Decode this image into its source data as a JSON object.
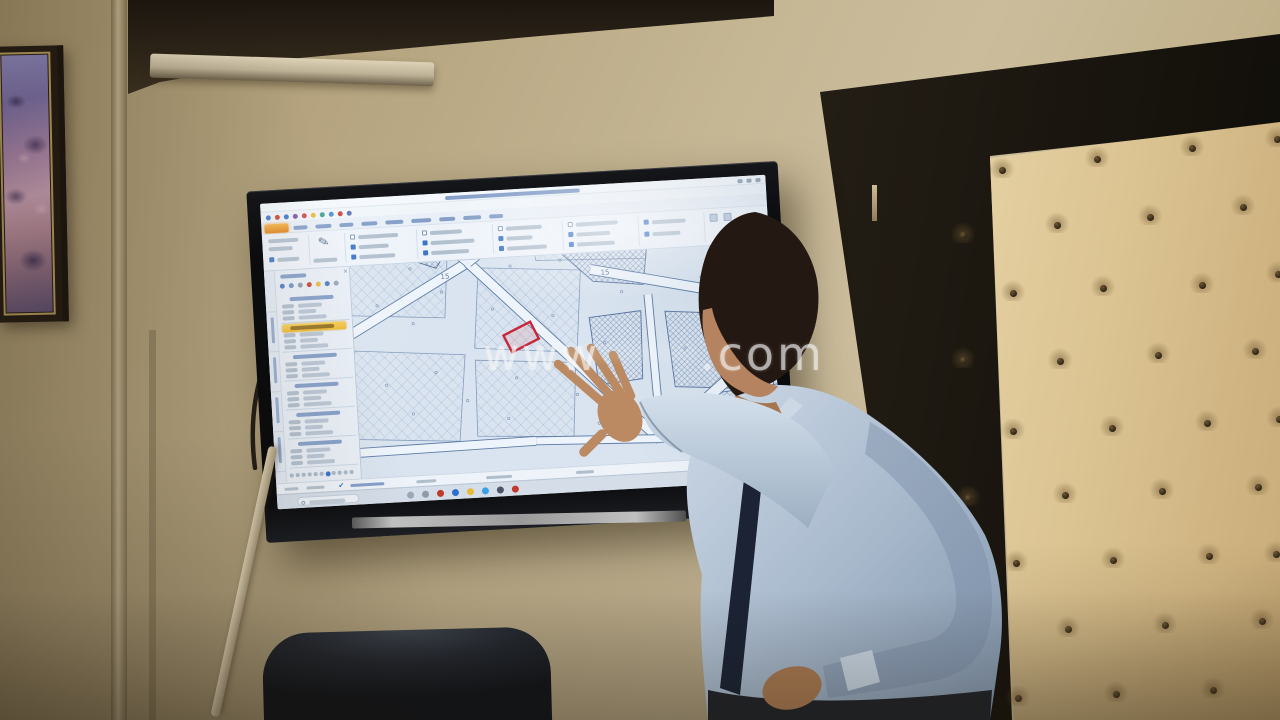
{
  "watermark": {
    "left": "www",
    "right": ".com"
  },
  "palette": {
    "wall": "#c5b694",
    "cornice": "#2a2014",
    "tuft_leather": "#ecd9ac",
    "door_frame": "#17130c",
    "shirt": "#b3c2d4",
    "tie": "#1b2335",
    "skin": "#bb8a62",
    "screen_bg": "#dce7f2",
    "highlight_marker": "#f3c13a",
    "file_button": "#e8920c",
    "red_parcel": "#c8273a",
    "start_blue": "#2f7fd6"
  },
  "screen": {
    "title": {
      "bar": [
        185,
        3,
        135
      ],
      "buttons": 3
    },
    "qat": {
      "y": 11,
      "x0": 5,
      "step": 9,
      "size": 5,
      "colors": [
        "#3a72c8",
        "#c94030",
        "#3a72c8",
        "#7a52a8",
        "#d04545",
        "#e8b93a",
        "#3aa089",
        "#4a8ad0",
        "#c94030",
        "#5a6fae"
      ]
    },
    "tabs": {
      "file": [
        3,
        20,
        24,
        9
      ],
      "y": 24,
      "items": [
        [
          32,
          14
        ],
        [
          54,
          16
        ],
        [
          78,
          14
        ],
        [
          100,
          16
        ],
        [
          124,
          18
        ],
        [
          150,
          20
        ],
        [
          178,
          16
        ],
        [
          202,
          18
        ],
        [
          228,
          14
        ]
      ]
    },
    "ribbon": {
      "seps": [
        46,
        82,
        154,
        230,
        300,
        376,
        442
      ],
      "pencil": [
        56,
        36
      ],
      "bars": [
        [
          6,
          36,
          30
        ],
        [
          6,
          44,
          24
        ],
        [
          50,
          58,
          24
        ]
      ],
      "g1cb": [
        6,
        54,
        22
      ],
      "cbgroups": [
        {
          "x": 88,
          "rows": [
            [
              36,
              40
            ],
            [
              46,
              30
            ],
            [
              56,
              36
            ]
          ]
        },
        {
          "x": 160,
          "rows": [
            [
              36,
              32
            ],
            [
              46,
              44
            ],
            [
              56,
              38
            ]
          ]
        },
        {
          "x": 236,
          "rows": [
            [
              36,
              36
            ],
            [
              46,
              26
            ],
            [
              56,
              40
            ]
          ]
        },
        {
          "x": 306,
          "rows": [
            [
              36,
              42
            ],
            [
              46,
              34
            ],
            [
              56,
              38
            ]
          ]
        },
        {
          "x": 382,
          "rows": [
            [
              38,
              34
            ],
            [
              50,
              28
            ]
          ]
        }
      ],
      "icon_squares": [
        [
          448,
          36
        ],
        [
          462,
          36
        ]
      ],
      "checked_pattern": [
        1,
        0,
        1,
        1,
        0,
        1,
        1,
        0,
        1,
        1,
        0,
        1,
        1,
        1
      ]
    },
    "panel": {
      "tabstrip": {
        "seps": [
          40,
          80,
          120,
          160,
          200
        ],
        "bars": [
          [
            46,
            26
          ],
          [
            86,
            26
          ],
          [
            126,
            26
          ],
          [
            166,
            26
          ]
        ]
      },
      "header_bar": [
        16,
        4,
        26
      ],
      "close": [
        79,
        4
      ],
      "tools": {
        "y": 13,
        "x0": 15,
        "step": 9,
        "colors": [
          "#4a7ac0",
          "#6b8fc9",
          "#8f9cab",
          "#c94030",
          "#e8b93a",
          "#4a7ac0",
          "#98a5b4"
        ]
      },
      "cards": {
        "y0": 24,
        "h": 29,
        "count": 6,
        "highlight_index": 1,
        "value_w": [
          24,
          18,
          28
        ]
      },
      "footer": {
        "y": 203,
        "x0": 14,
        "step": 6,
        "count": 11,
        "active_index": 6,
        "active_color": "#2f6fd0"
      }
    },
    "status": {
      "bars": [
        [
          8,
          14
        ],
        [
          30,
          18
        ],
        [
          74,
          34
        ],
        [
          140,
          20
        ],
        [
          210,
          26
        ],
        [
          300,
          18
        ],
        [
          468,
          24
        ]
      ],
      "check_x": 62,
      "check": "✔"
    },
    "taskbar": {
      "search": [
        20,
        3,
        62,
        9
      ],
      "icons": {
        "x0": 130,
        "step": 15,
        "size": 7,
        "names": [
          "pinned-app-icon",
          "pinned-app-icon",
          "browser-red-icon",
          "edge-icon",
          "files-icon",
          "skype-icon",
          "office-icon",
          "media-red-icon"
        ],
        "colors": [
          "#9aa7b6",
          "#8d9aa9",
          "#c0392b",
          "#2c6fd0",
          "#e8b93a",
          "#3aa0e8",
          "#4a5568",
          "#c0392b"
        ]
      },
      "tray_x": 466
    },
    "map": {
      "w": 420,
      "h": 211,
      "streets": [
        [
          118,
          2,
          -30,
          82,
          9
        ],
        [
          118,
          2,
          300,
          190,
          9
        ],
        [
          118,
          2,
          196,
          -54,
          9
        ],
        [
          118,
          2,
          54,
          -56,
          8
        ],
        [
          -10,
          186,
          176,
          184,
          8
        ],
        [
          176,
          184,
          302,
          189,
          7
        ],
        [
          302,
          189,
          430,
          177,
          7
        ],
        [
          302,
          189,
          420,
          94,
          10
        ],
        [
          240,
          16,
          432,
          60,
          9
        ],
        [
          296,
          44,
          301,
          187,
          7
        ]
      ],
      "hatch_blocks": [
        "205,-8 298,-8 292,34 242,28",
        "312,62 420,72 416,146 318,138",
        "322,150 430,140 430,208 330,206",
        "360,-8 430,-8 430,28 368,24",
        "236,64 288,60 286,128 242,132",
        "44,-44 108,-26 86,6 30,-16"
      ],
      "grid_blocks": [
        "0,84 110,94 100,180 -8,172",
        "-8,-40 100,-30 92,56 -8,48",
        "120,100 220,108 214,182 118,176",
        "128,8 230,16 222,98 120,88",
        "180,-48 300,-40 296,8 186,4"
      ],
      "parcel_dots": [
        [
          30,
          120
        ],
        [
          55,
          150
        ],
        [
          80,
          110
        ],
        [
          60,
          60
        ],
        [
          90,
          30
        ],
        [
          140,
          50
        ],
        [
          160,
          120
        ],
        [
          200,
          60
        ],
        [
          220,
          140
        ],
        [
          250,
          90
        ],
        [
          150,
          160
        ],
        [
          110,
          140
        ],
        [
          240,
          170
        ],
        [
          270,
          40
        ],
        [
          330,
          100
        ],
        [
          350,
          30
        ],
        [
          390,
          120
        ],
        [
          370,
          180
        ],
        [
          60,
          5
        ],
        [
          160,
          8
        ],
        [
          210,
          5
        ],
        [
          25,
          40
        ]
      ],
      "labels": [
        {
          "text": "15",
          "x": 250,
          "y": 22
        },
        {
          "text": "15",
          "x": 90,
          "y": 17
        }
      ],
      "red_parcel": {
        "x": 152,
        "y": 70,
        "w": 30,
        "h": 19,
        "rot": -24
      }
    }
  },
  "tuft_buttons": [
    [
      1002,
      172
    ],
    [
      1097,
      161
    ],
    [
      1192,
      150
    ],
    [
      1277,
      141
    ],
    [
      963,
      237
    ],
    [
      1057,
      227
    ],
    [
      1150,
      219
    ],
    [
      1243,
      209
    ],
    [
      1013,
      295
    ],
    [
      1103,
      290
    ],
    [
      1202,
      287
    ],
    [
      1278,
      276
    ],
    [
      963,
      362
    ],
    [
      1060,
      363
    ],
    [
      1158,
      357
    ],
    [
      1255,
      353
    ],
    [
      1013,
      433
    ],
    [
      1112,
      430
    ],
    [
      1207,
      425
    ],
    [
      1279,
      421
    ],
    [
      968,
      500
    ],
    [
      1065,
      497
    ],
    [
      1162,
      493
    ],
    [
      1258,
      489
    ],
    [
      1016,
      565
    ],
    [
      1113,
      562
    ],
    [
      1209,
      558
    ],
    [
      1276,
      556
    ],
    [
      970,
      635
    ],
    [
      1068,
      631
    ],
    [
      1165,
      627
    ],
    [
      1262,
      623
    ],
    [
      1018,
      700
    ],
    [
      1116,
      696
    ],
    [
      1213,
      692
    ]
  ]
}
